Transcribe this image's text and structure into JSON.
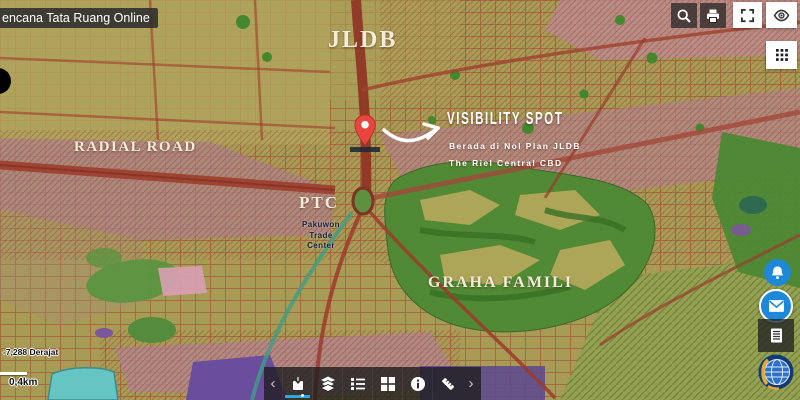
{
  "header": {
    "title": "encana Tata Ruang Online"
  },
  "map_labels": {
    "region_title": "JLDB",
    "road": "RADIAL ROAD",
    "spot_title": "VISIBILITY SPOT",
    "spot_line1": "Berada di Nol Plan JLDB",
    "spot_line2": "The Riel Central CBD",
    "ptc": "PTC",
    "ptc_sub": [
      "Pakuwon",
      "Trade",
      "Center"
    ],
    "area": "GRAHA FAMILI"
  },
  "colors": {
    "accent_blue": "#29abe2",
    "button_blue": "#1e88d8",
    "marker_red": "#e8453f"
  },
  "top_right_toolbar": {
    "icons": [
      "search",
      "print",
      "fullscreen",
      "eye",
      "apps-grid"
    ]
  },
  "right_rail": {
    "icons": [
      "bell",
      "email",
      "feedback-form",
      "ministry-globe-logo"
    ]
  },
  "status_bar": {
    "coordinates": "-7,288 Derajat",
    "scale_label": "0,4km"
  },
  "bottom_toolbar": {
    "prev": "‹",
    "next": "›",
    "icons": [
      "basemap",
      "layers",
      "legend",
      "grid",
      "info",
      "measure"
    ],
    "active_index": 0
  }
}
